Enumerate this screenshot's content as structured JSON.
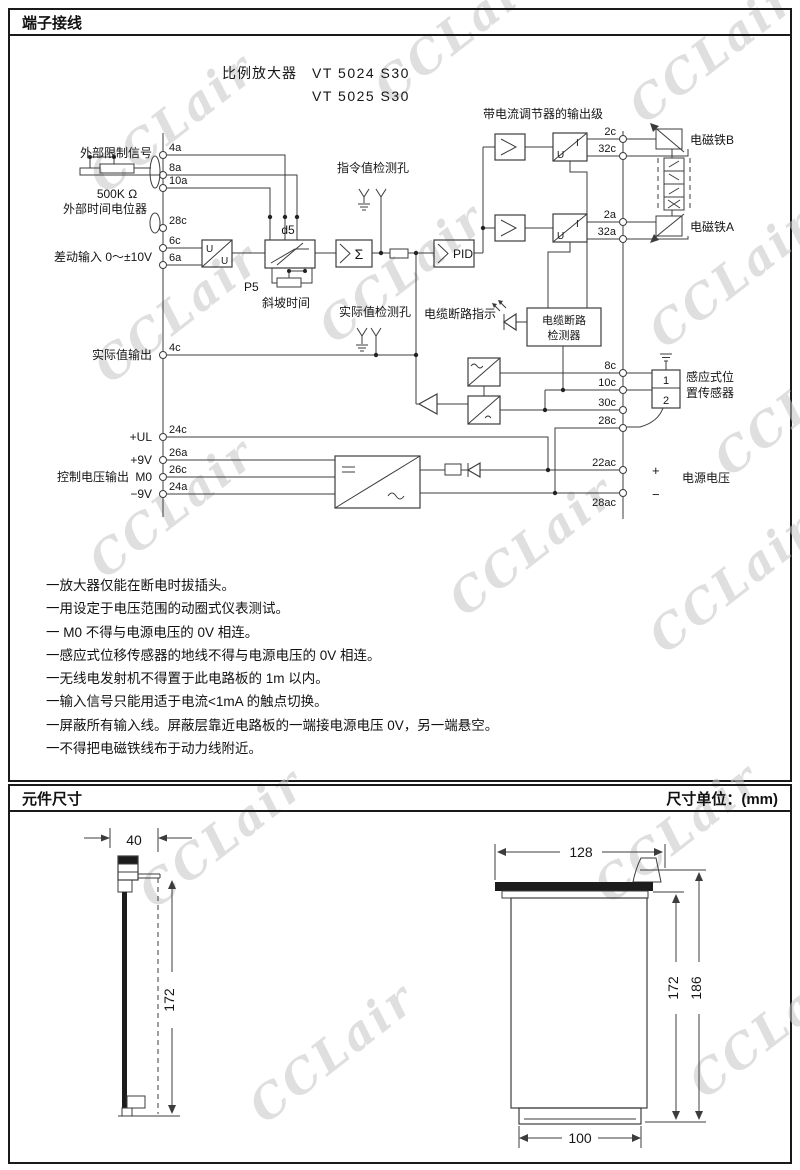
{
  "page": {
    "section1_title": "端子接线",
    "section2_title": "元件尺寸",
    "unit_label": "尺寸单位：(mm)",
    "watermark": "CCLair"
  },
  "diagram": {
    "device_label": "比例放大器",
    "model1": "VT 5024 S30",
    "model2": "VT 5025 S30",
    "labels": {
      "external_limit_signal": "外部限制信号",
      "resistor_value": "500K Ω",
      "external_time_pot": "外部时间电位器",
      "differential_input": "差动输入  0～±10V",
      "p5": "P5",
      "ramp_time": "斜坡时间",
      "d5": "d5",
      "sigma": "Σ",
      "pid": "PID",
      "u": "U",
      "i": "I",
      "command_test_hole": "指令值检测孔",
      "actual_test_hole": "实际值检测孔",
      "cable_break_indicator": "电缆断路指示",
      "detector_line1": "电缆断路",
      "detector_line2": "检测器",
      "output_stage": "带电流调节器的输出级",
      "solenoid_b": "电磁铁B",
      "solenoid_a": "电磁铁A",
      "actual_value_output": "实际值输出",
      "sensor_line1": "感应式位",
      "sensor_line2": "置传感器",
      "sensor_pin1": "1",
      "sensor_pin2": "2",
      "plus_ul": "+UL",
      "control_voltage_output": "控制电压输出",
      "plus_9v": "+9V",
      "m0": "M0",
      "minus_9v": "−9V",
      "power_voltage": "电源电压",
      "plus": "+",
      "minus": "−"
    },
    "terminals": {
      "t4a": "4a",
      "t8a": "8a",
      "t10a": "10a",
      "t28c_left": "28c",
      "t6c": "6c",
      "t6a": "6a",
      "t4c": "4c",
      "t24c": "24c",
      "t26a": "26a",
      "t26c": "26c",
      "t24a": "24a",
      "t2c": "2c",
      "t32c": "32c",
      "t2a": "2a",
      "t32a": "32a",
      "t8c": "8c",
      "t10c": "10c",
      "t30c": "30c",
      "t28c_right": "28c",
      "t22ac": "22ac",
      "t28ac": "28ac"
    }
  },
  "notes": [
    "一放大器仅能在断电时拔插头。",
    "一用设定于电压范围的动圈式仪表测试。",
    "一 M0 不得与电源电压的 0V 相连。",
    "一感应式位移传感器的地线不得与电源电压的 0V 相连。",
    "一无线电发射机不得置于此电路板的 1m 以内。",
    "一输入信号只能用适于电流<1mA 的触点切换。",
    "一屏蔽所有输入线。屏蔽层靠近电路板的一端接电源电压 0V，另一端悬空。",
    "一不得把电磁铁线布于动力线附近。"
  ],
  "dimensions": {
    "card_width": "40",
    "card_height": "172",
    "panel_width": "128",
    "body_height": "172",
    "total_height": "186",
    "connector_width": "100"
  }
}
